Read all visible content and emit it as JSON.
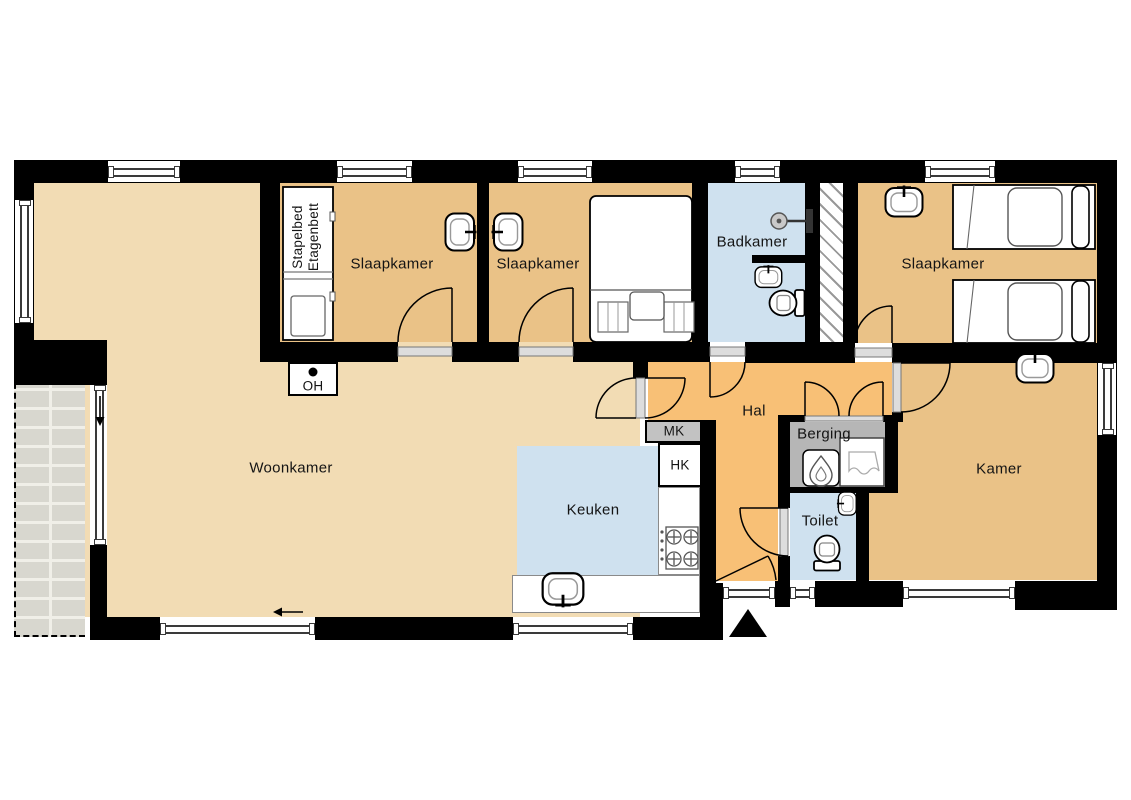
{
  "rooms": {
    "woonkamer": {
      "label": "Woonkamer"
    },
    "slaapkamer1": {
      "label": "Slaapkamer"
    },
    "slaapkamer2": {
      "label": "Slaapkamer"
    },
    "slaapkamer3": {
      "label": "Slaapkamer"
    },
    "badkamer": {
      "label": "Badkamer"
    },
    "hal": {
      "label": "Hal"
    },
    "keuken": {
      "label": "Keuken"
    },
    "berging": {
      "label": "Berging"
    },
    "toilet": {
      "label": "Toilet"
    },
    "kamer": {
      "label": "Kamer"
    }
  },
  "annotations": {
    "mk": "MK",
    "hk": "HK",
    "oh": "OH",
    "bunk_bed_line1": "Stapelbed",
    "bunk_bed_line2": "Etagenbett"
  },
  "colors": {
    "wall": "#000000",
    "floor_living": "#f2dcb4",
    "floor_bedroom": "#eac287",
    "floor_hall": "#f8c076",
    "floor_wet": "#cfe1ef",
    "floor_storage": "#b6b6b6",
    "box_meter": "#c2c2c2",
    "terrace_brick": "#d8d7cf"
  }
}
